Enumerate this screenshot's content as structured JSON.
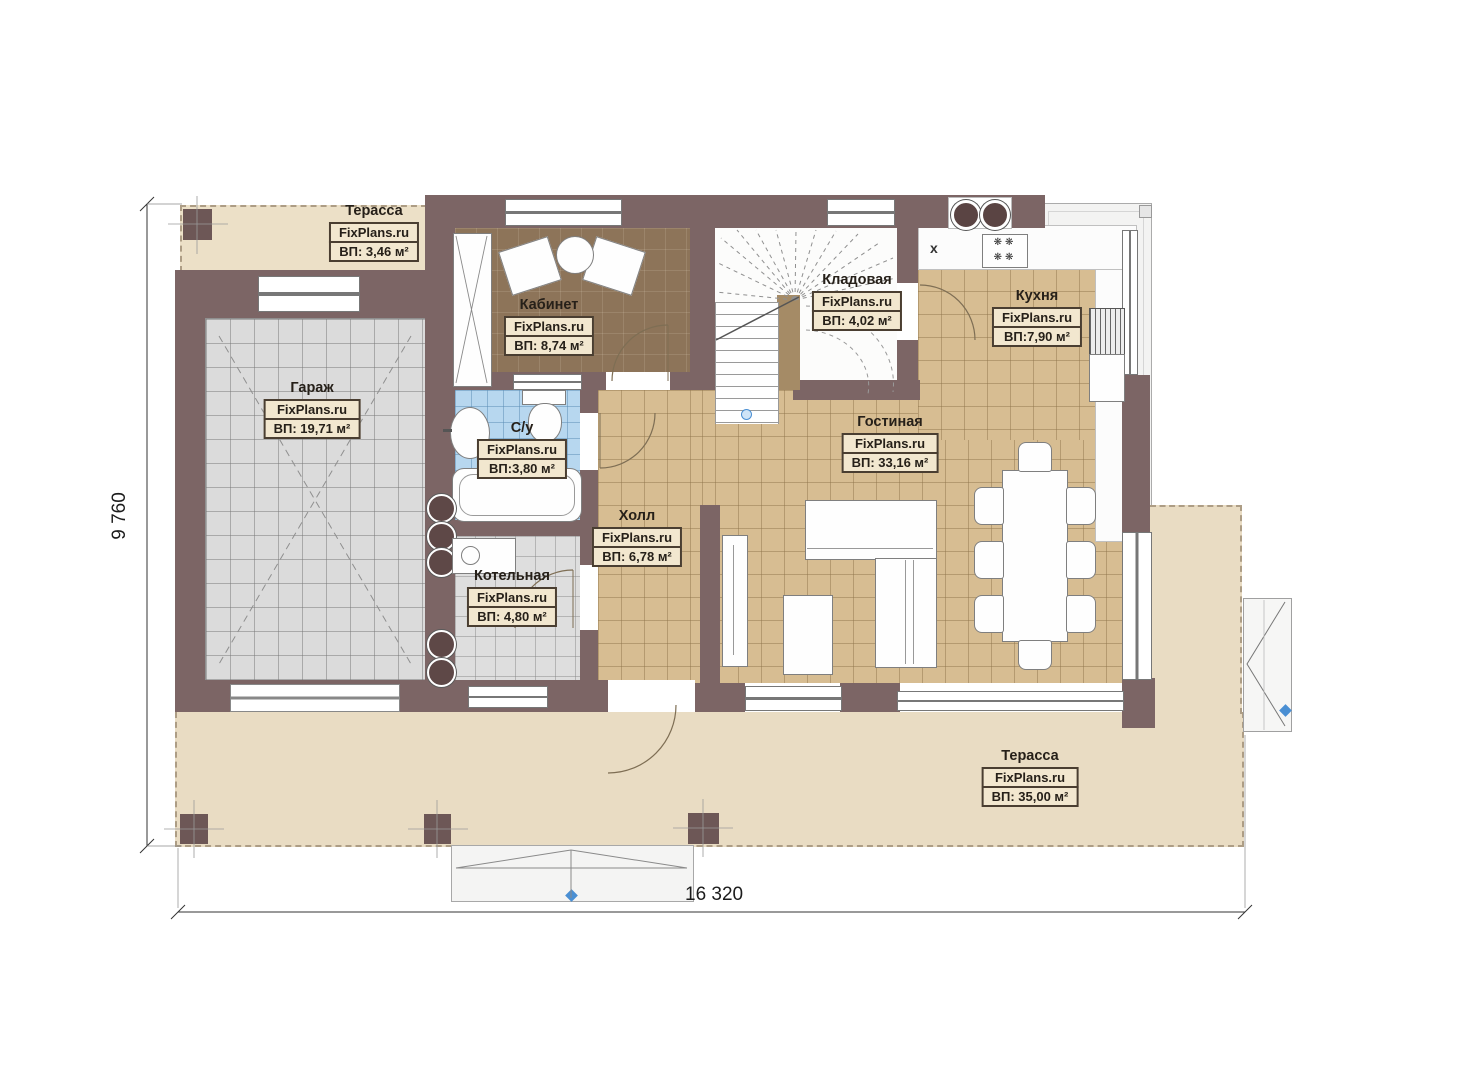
{
  "plan": {
    "watermark": "FixPlans.ru",
    "rooms": [
      {
        "id": "terrace-top",
        "name": "Терасса",
        "area": "ВП: 3,46 м²"
      },
      {
        "id": "garage",
        "name": "Гараж",
        "area": "ВП: 19,71 м²"
      },
      {
        "id": "office",
        "name": "Кабинет",
        "area": "ВП: 8,74 м²"
      },
      {
        "id": "bathroom",
        "name": "С/у",
        "area": "ВП:3,80 м²"
      },
      {
        "id": "boiler",
        "name": "Котельная",
        "area": "ВП: 4,80 м²"
      },
      {
        "id": "hall",
        "name": "Холл",
        "area": "ВП: 6,78 м²"
      },
      {
        "id": "storage",
        "name": "Кладовая",
        "area": "ВП: 4,02 м²"
      },
      {
        "id": "kitchen",
        "name": "Кухня",
        "area": "ВП:7,90 м²"
      },
      {
        "id": "living",
        "name": "Гостиная",
        "area": "ВП: 33,16 м²"
      },
      {
        "id": "terrace-main",
        "name": "Терасса",
        "area": "ВП: 35,00 м²"
      }
    ],
    "dimensions": {
      "height_label": "9 760",
      "width_label": "16 320"
    },
    "symbols": {
      "kitchen_hood": "x"
    },
    "colors": {
      "wall": "#7c6565",
      "tile_tan": "#d7bd92",
      "tile_bath": "#b7d7ef",
      "terrace": "#e9dcc3",
      "label_box": "#f2e7cf",
      "marker_blue": "#4a8fd3"
    }
  }
}
